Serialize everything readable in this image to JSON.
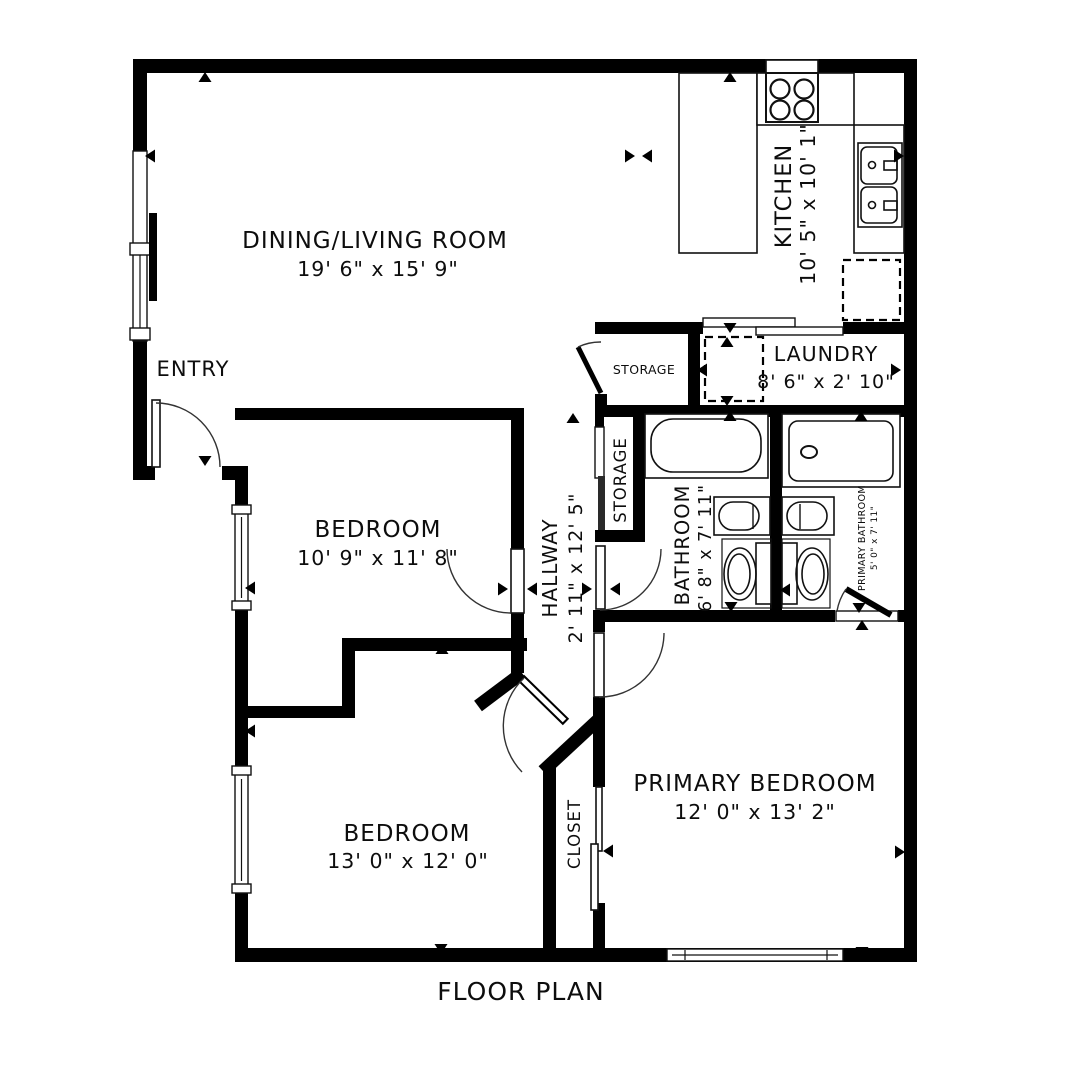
{
  "title": "FLOOR PLAN",
  "rooms": {
    "dining_living": {
      "name": "DINING/LIVING ROOM",
      "dims": "19' 6\" x 15' 9\""
    },
    "kitchen": {
      "name": "KITCHEN",
      "dims": "10' 5\" x 10' 1\""
    },
    "entry": {
      "name": "ENTRY"
    },
    "storage_upper": {
      "name": "STORAGE"
    },
    "laundry": {
      "name": "LAUNDRY",
      "dims": "8' 6\" x 2' 10\""
    },
    "storage_hall": {
      "name": "STORAGE"
    },
    "bathroom": {
      "name": "BATHROOM",
      "dims": "6' 8\" x 7' 11\""
    },
    "primary_bathroom": {
      "name": "PRIMARY BATHROOM",
      "dims": "5' 0\" x 7' 11\""
    },
    "hallway": {
      "name": "HALLWAY",
      "dims": "2' 11\" x 12' 5\""
    },
    "bedroom_middle": {
      "name": "BEDROOM",
      "dims": "10' 9\" x 11' 8\""
    },
    "bedroom_lower": {
      "name": "BEDROOM",
      "dims": "13' 0\" x 12' 0\""
    },
    "closet": {
      "name": "CLOSET"
    },
    "primary_bedroom": {
      "name": "PRIMARY BEDROOM",
      "dims": "12' 0\" x 13' 2\""
    }
  },
  "fixtures": {
    "stove": "stove-icon",
    "kitchen_sink": "double-sink-icon",
    "refrigerator": "refrigerator-dashed-box",
    "washer": "washer-dashed-box",
    "bathtub": "bathtub-icon",
    "shower": "shower-icon",
    "toilets": "toilet-icon",
    "vanities": "vanity-sink-icon"
  },
  "colors": {
    "wall": "#000000",
    "background": "#ffffff",
    "line": "#111111"
  }
}
